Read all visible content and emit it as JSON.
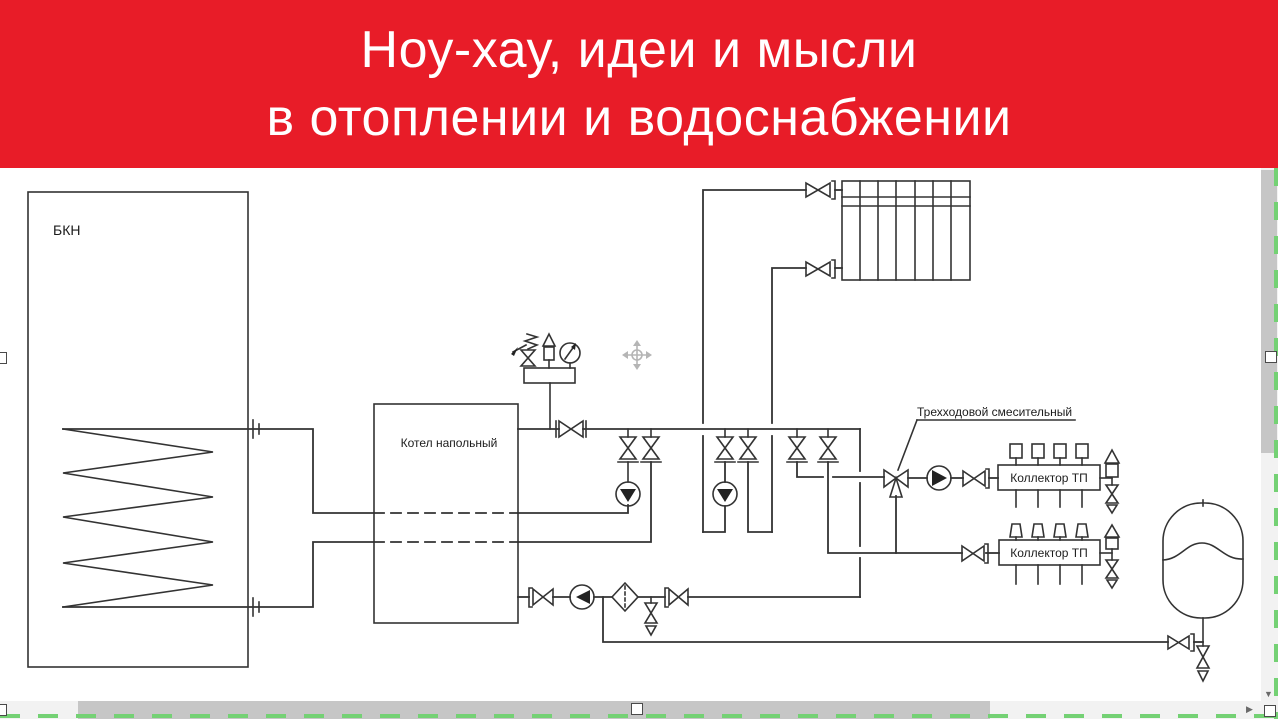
{
  "banner": {
    "title_line1": "Ноу-хау, идеи и мысли",
    "title_line2": "в отоплении и водоснабжении",
    "bg_color": "#e81c28",
    "text_color": "#ffffff"
  },
  "diagram": {
    "tank_label": "БКН",
    "boiler_label": "Котел напольный",
    "three_way_label": "Трехходовой смесительный",
    "collector1_label": "Коллектор ТП",
    "collector2_label": "Коллектор ТП",
    "line_color": "#333333"
  },
  "scrollbar": {
    "down_arrow_icon": "▼",
    "right_arrow_icon": "▶",
    "thumb_color": "#c6c6c6",
    "track_color": "#f2f2f2"
  },
  "selection": {
    "dash_color": "#74d174",
    "handle_fill": "#ffffff"
  }
}
